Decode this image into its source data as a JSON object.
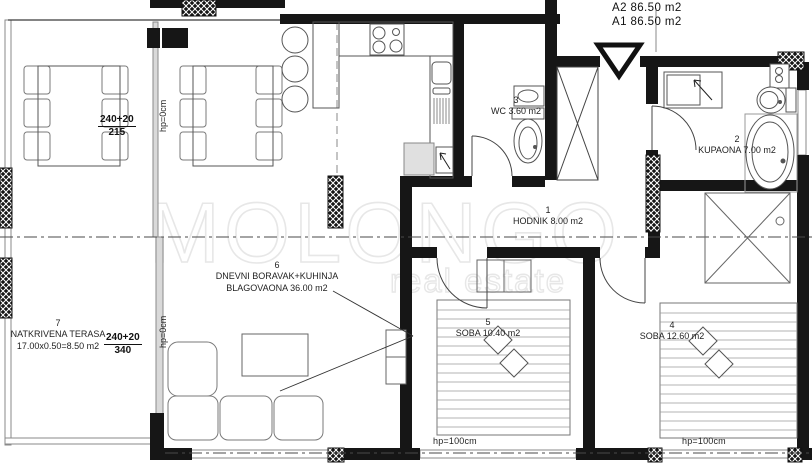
{
  "plan": {
    "apartments": {
      "a2": "A2 86.50 m2",
      "a1": "A1 86.50 m2"
    },
    "rooms": {
      "hodnik": {
        "num": "1",
        "name": "HODNIK 8.00 m2"
      },
      "kupaona": {
        "num": "2",
        "name": "KUPAONA 7.00 m2"
      },
      "wc": {
        "num": "3",
        "name": "WC 3.60 m2"
      },
      "soba4": {
        "num": "4",
        "name": "SOBA 12.60 m2"
      },
      "soba5": {
        "num": "5",
        "name": "SOBA 10.40 m2"
      },
      "dnevni": {
        "num": "6",
        "name": "DNEVNI BORAVAK+KUHINJA",
        "name2": "BLAGOVAONA 36.00 m2"
      },
      "terasa": {
        "num": "7",
        "name": "NATKRIVENA TERASA",
        "name2": "17.00x0.50=8.50 m2"
      }
    },
    "dimensions": {
      "dining": {
        "top": "240+20",
        "bottom": "215"
      },
      "terrace": {
        "top": "240+20",
        "bottom": "340"
      },
      "parapet_zero": "hp=0cm",
      "parapet_window": "hp=100cm"
    },
    "watermark": {
      "brand": "MOLONGO",
      "tagline": "real estate"
    },
    "colors": {
      "wall": "#161616",
      "thin_line": "#777777",
      "axis": "#4a4a4a",
      "watermark": "#e7e7e7"
    }
  }
}
